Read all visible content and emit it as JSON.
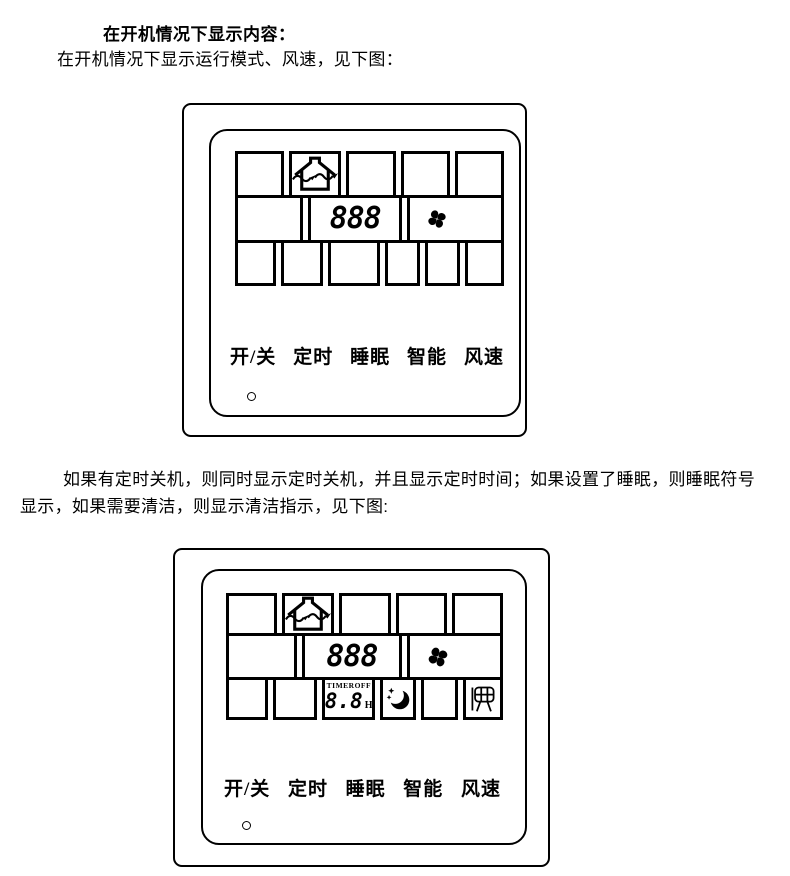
{
  "document": {
    "heading": "在开机情况下显示内容：",
    "intro": "在开机情况下显示运行模式、风速，见下图：",
    "paragraph": "如果有定时关机，则同时显示定时关机，并且显示定时时间；如果设置了睡眠，则睡眠符号显示，如果需要清洁，则显示清洁指示，见下图:"
  },
  "controller": {
    "buttons": [
      "开/关",
      "定时",
      "睡眠",
      "智能",
      "风速"
    ],
    "display": {
      "temperature": "888",
      "timer_label": "TIMER",
      "timer_state": "OFF",
      "timer_hours": "8.8",
      "timer_unit": "H"
    },
    "icons": {
      "mode": "house-ventilation-icon",
      "fan": "fan-blades-icon",
      "sleep": "moon-stars-icon",
      "clean": "filter-clean-icon",
      "led": "power-indicator-dot"
    },
    "colors": {
      "ink": "#000000",
      "paper": "#ffffff"
    }
  }
}
